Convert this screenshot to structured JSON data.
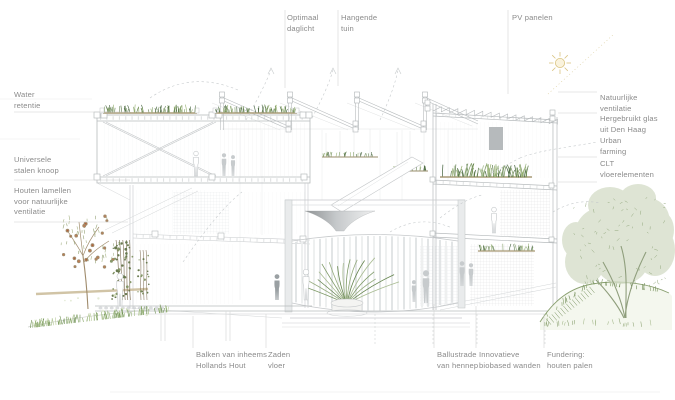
{
  "diagram": {
    "type": "architectural section illustration",
    "language": "nl"
  },
  "annotations": {
    "top": [
      {
        "text": "Optimaal\ndaglicht"
      },
      {
        "text": "Hangende\ntuin"
      },
      {
        "text": "PV panelen"
      }
    ],
    "left": [
      {
        "text": "Water\nretentie"
      },
      {
        "text": "Universele\nstalen knoop"
      },
      {
        "text": "Houten lamellen\nvoor natuurlijke\nventilatie"
      }
    ],
    "right": [
      {
        "text": "Natuurlijke\nventilatie"
      },
      {
        "text": "Hergebruikt glas\nuit Den Haag"
      },
      {
        "text": "Urban\nfarming"
      },
      {
        "text": "CLT\nvloerelementen"
      }
    ],
    "bottom": [
      {
        "text": "Balken van inheems\nHollands Hout"
      },
      {
        "text": "Zaden\nvloer"
      },
      {
        "text": "Ballustrade\nvan hennep"
      },
      {
        "text": "Innovatieve\nbiobased wanden"
      },
      {
        "text": "Fundering:\nhouten palen"
      }
    ]
  },
  "icons": [
    {
      "name": "sun-icon",
      "meaning": "zon"
    }
  ],
  "colors": {
    "label_text": "#8b8b8b",
    "leader_line": "#cfcfcf",
    "drawing_line": "#b7bbbd",
    "vegetation_green": "#7d9a62",
    "vegetation_light": "#a8bc8f",
    "soil": "#b5a88a",
    "fruit_accent": "#c8764b",
    "sun_yellow": "#d9c37f"
  }
}
